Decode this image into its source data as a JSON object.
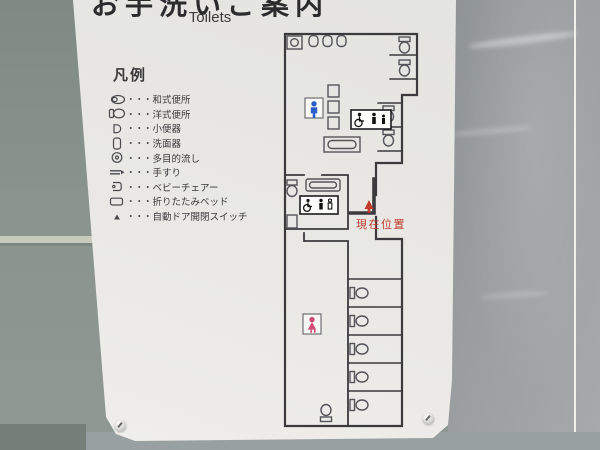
{
  "sign": {
    "title_jp": "お手洗いご案内",
    "title_en": "Toilets",
    "legend": {
      "title": "凡例",
      "separator": "・・・",
      "items": [
        {
          "icon": "squat-toilet-icon",
          "label": "和式便所"
        },
        {
          "icon": "western-toilet-icon",
          "label": "洋式便所"
        },
        {
          "icon": "urinal-icon",
          "label": "小便器"
        },
        {
          "icon": "washbasin-icon",
          "label": "洗面器"
        },
        {
          "icon": "multipurpose-sink-icon",
          "label": "多目的流し"
        },
        {
          "icon": "handrail-icon",
          "label": "手すり"
        },
        {
          "icon": "baby-chair-icon",
          "label": "ベビーチェアー"
        },
        {
          "icon": "folding-bed-icon",
          "label": "折りたたみベッド"
        },
        {
          "icon": "auto-door-switch-icon",
          "label": "自動ドア開閉スイッチ"
        }
      ]
    },
    "map": {
      "current_location_label": "現在位置",
      "colors": {
        "wall_line": "#3b3b3d",
        "male_icon": "#2b5fc7",
        "female_icon": "#d04a78",
        "current_location": "#c0392b"
      }
    }
  }
}
